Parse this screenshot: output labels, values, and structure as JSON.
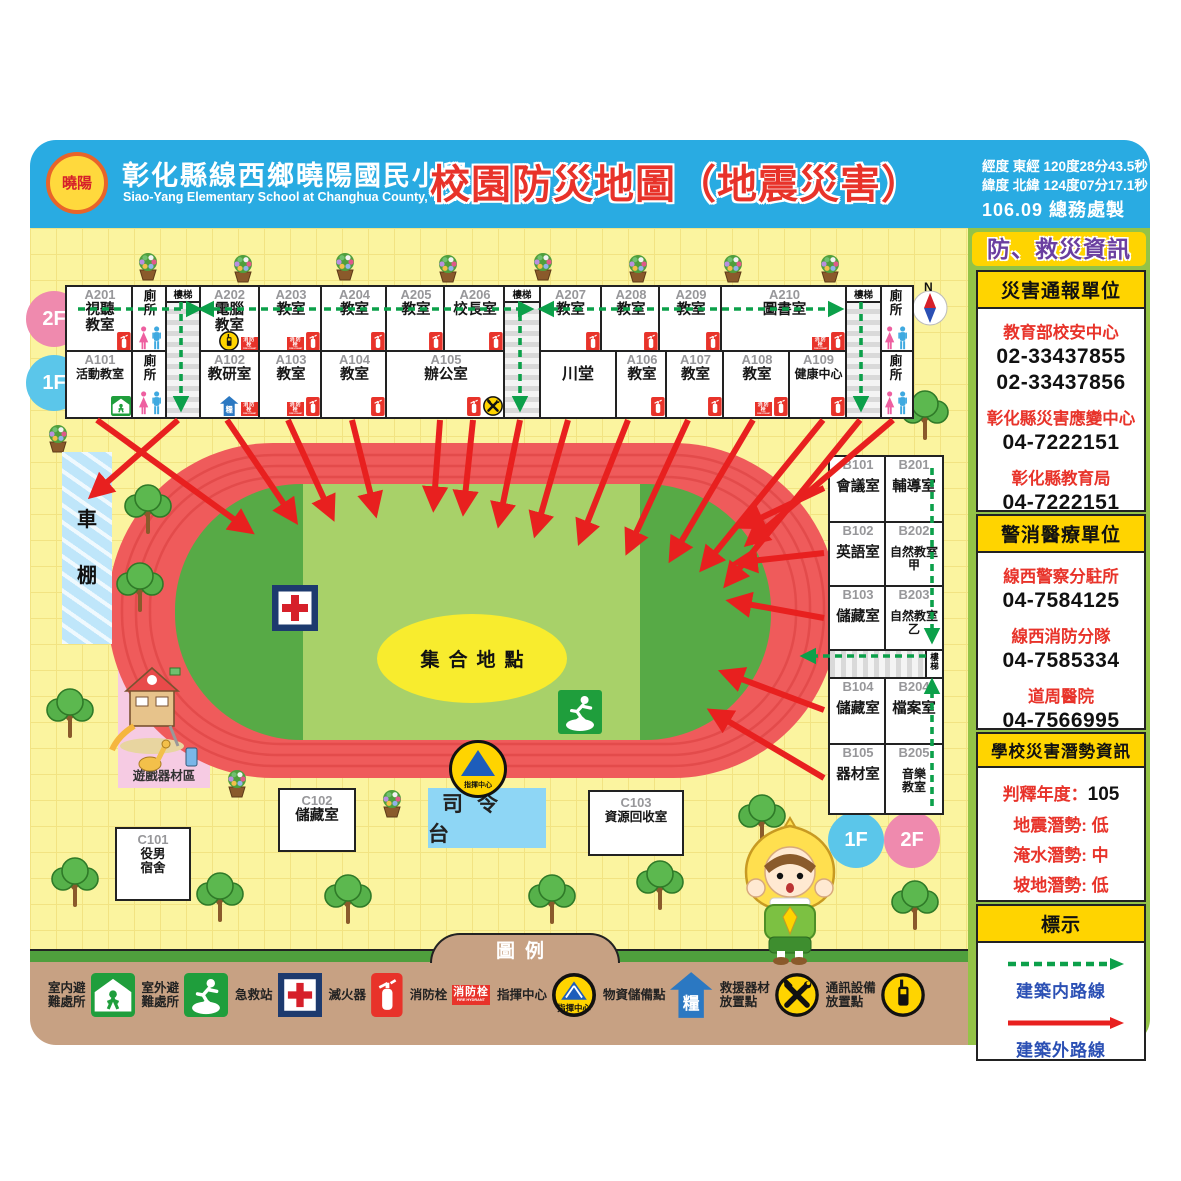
{
  "header": {
    "school_name": "彰化縣線西鄉曉陽國民小學",
    "school_name_en": "Siao-Yang Elementary School at Changhua County, Taiwan",
    "title": "校園防災地圖（地震災害）",
    "coord_line1": "經度 東經 120度28分43.5秒",
    "coord_line2": "緯度 北緯 124度07分17.1秒",
    "edition": "106.09 總務處製",
    "logo_text": "曉陽"
  },
  "sidebar": {
    "title": "防、救災資訊",
    "contact_sections": [
      {
        "header": "災害通報單位",
        "height": 238,
        "entries": [
          {
            "name": "教育部校安中心",
            "phones": [
              "02-33437855",
              "02-33437856"
            ]
          },
          {
            "name": "彰化縣災害應變中心",
            "phones": [
              "04-7222151"
            ]
          },
          {
            "name": "彰化縣教育局",
            "phones": [
              "04-7222151"
            ]
          }
        ]
      },
      {
        "header": "警消醫療單位",
        "height": 212,
        "entries": [
          {
            "name": "線西警察分駐所",
            "phones": [
              "04-7584125"
            ]
          },
          {
            "name": "線西消防分隊",
            "phones": [
              "04-7585334"
            ]
          },
          {
            "name": "道周醫院",
            "phones": [
              "04-7566995"
            ]
          }
        ]
      }
    ],
    "potential_section": {
      "header": "學校災害潛勢資訊",
      "year_label": "判釋年度：",
      "year_value": "105",
      "rows": [
        {
          "label": "地震潛勢:",
          "value": "低"
        },
        {
          "label": "淹水潛勢:",
          "value": "中"
        },
        {
          "label": "坡地潛勢:",
          "value": "低"
        },
        {
          "label": "人為潛勢:",
          "value": "低"
        }
      ]
    },
    "routes_section": {
      "header": "標示",
      "routes": [
        {
          "label": "建築内路線",
          "style": "green-dashed"
        },
        {
          "label": "建築外路線",
          "style": "red-solid"
        }
      ]
    }
  },
  "map": {
    "compass": "N",
    "stairs_label": "樓梯",
    "toilet_label": "廁\n所",
    "labels": {
      "assembly": "集合地點",
      "stage": "司令台",
      "command": "指揮中心",
      "shed": "車\n棚",
      "playground": "遊戲器材區"
    },
    "building_a": {
      "f2_badge": "2F",
      "f1_badge": "1F",
      "f2": [
        {
          "id": "A201",
          "name": "視聽\n教室",
          "x": 65,
          "w": 66,
          "icons": [
            "extinguisher"
          ]
        },
        {
          "type": "toilet",
          "x": 131,
          "w": 34
        },
        {
          "id": "A202",
          "name": "電腦\n教室",
          "x": 197,
          "w": 61,
          "icons": [
            "comm-device",
            "hydrant"
          ]
        },
        {
          "id": "A203",
          "name": "教室",
          "x": 258,
          "w": 62,
          "icons": [
            "hydrant",
            "extinguisher"
          ]
        },
        {
          "id": "A204",
          "name": "教室",
          "x": 320,
          "w": 65,
          "icons": [
            "extinguisher"
          ]
        },
        {
          "id": "A205",
          "name": "教室",
          "x": 385,
          "w": 58,
          "icons": [
            "extinguisher"
          ]
        },
        {
          "id": "A206",
          "name": "校長室",
          "x": 443,
          "w": 60,
          "icons": [
            "extinguisher"
          ]
        },
        {
          "id": "A207",
          "name": "教室",
          "x": 537,
          "w": 63,
          "icons": [
            "extinguisher"
          ]
        },
        {
          "id": "A208",
          "name": "教室",
          "x": 600,
          "w": 58,
          "icons": [
            "extinguisher"
          ]
        },
        {
          "id": "A209",
          "name": "教室",
          "x": 658,
          "w": 62,
          "icons": [
            "extinguisher"
          ]
        },
        {
          "id": "A210",
          "name": "圖書室",
          "x": 720,
          "w": 125,
          "icons": [
            "hydrant",
            "extinguisher"
          ]
        },
        {
          "type": "toilet",
          "x": 878,
          "w": 32
        }
      ],
      "f1": [
        {
          "id": "A101",
          "name": "活動教室",
          "x": 65,
          "w": 66,
          "icons": [
            "indoor-shelter"
          ]
        },
        {
          "type": "toilet",
          "x": 131,
          "w": 34
        },
        {
          "id": "A102",
          "name": "教研室",
          "x": 197,
          "w": 61,
          "icons": [
            "supply",
            "hydrant"
          ]
        },
        {
          "id": "A103",
          "name": "教室",
          "x": 258,
          "w": 62,
          "icons": [
            "hydrant",
            "extinguisher"
          ]
        },
        {
          "id": "A104",
          "name": "教室",
          "x": 320,
          "w": 65,
          "icons": [
            "extinguisher"
          ]
        },
        {
          "id": "A105",
          "name": "辦公室",
          "x": 385,
          "w": 118,
          "icons": [
            "extinguisher",
            "rescue-tools"
          ]
        },
        {
          "id": "",
          "name": "川堂",
          "x": 537,
          "w": 78,
          "icons": []
        },
        {
          "id": "A106",
          "name": "教室",
          "x": 615,
          "w": 50,
          "icons": [
            "extinguisher"
          ]
        },
        {
          "id": "A107",
          "name": "教室",
          "x": 665,
          "w": 57,
          "icons": [
            "extinguisher"
          ]
        },
        {
          "id": "A108",
          "name": "教室",
          "x": 722,
          "w": 66,
          "icons": [
            "hydrant",
            "extinguisher"
          ]
        },
        {
          "id": "A109",
          "name": "健康中心",
          "x": 788,
          "w": 57,
          "icons": [
            "extinguisher"
          ]
        },
        {
          "type": "toilet",
          "x": 878,
          "w": 32
        }
      ],
      "stairs": [
        {
          "x": 165,
          "w": 32
        },
        {
          "x": 503,
          "w": 34
        },
        {
          "x": 845,
          "w": 33
        }
      ]
    },
    "building_b": {
      "f1_badge": "1F",
      "f2_badge": "2F",
      "rows": [
        {
          "h": 66,
          "f1": {
            "id": "B101",
            "name": "會議室"
          },
          "f2": {
            "id": "B201",
            "name": "輔導室"
          }
        },
        {
          "h": 64,
          "f1": {
            "id": "B102",
            "name": "英語室"
          },
          "f2": {
            "id": "B202",
            "name": "自然教室\n甲"
          }
        },
        {
          "h": 64,
          "f1": {
            "id": "B103",
            "name": "儲藏室"
          },
          "f2": {
            "id": "B203",
            "name": "自然教室\n乙"
          }
        },
        {
          "h": 28,
          "stairs": true
        },
        {
          "h": 66,
          "f1": {
            "id": "B104",
            "name": "儲藏室"
          },
          "f2": {
            "id": "B204",
            "name": "檔案室"
          }
        },
        {
          "h": 68,
          "f1": {
            "id": "B105",
            "name": "器材室"
          },
          "f2": {
            "id": "B205",
            "name": "音樂\n教室"
          }
        }
      ]
    },
    "c_rooms": [
      {
        "id": "C101",
        "name": "役男\n宿舍",
        "x": 115,
        "y": 827,
        "w": 72,
        "h": 70
      },
      {
        "id": "C102",
        "name": "儲藏室",
        "x": 278,
        "y": 788,
        "w": 74,
        "h": 60
      },
      {
        "id": "C103",
        "name": "資源回收室",
        "x": 588,
        "y": 790,
        "w": 92,
        "h": 62
      }
    ],
    "routes": {
      "green": [
        [
          78,
          309,
          196,
          309
        ],
        [
          316,
          309,
          204,
          309
        ],
        [
          324,
          309,
          528,
          309
        ],
        [
          654,
          309,
          544,
          309
        ],
        [
          662,
          309,
          838,
          309
        ],
        [
          181,
          302,
          181,
          406
        ],
        [
          520,
          302,
          520,
          406
        ],
        [
          861,
          302,
          861,
          406
        ],
        [
          932,
          468,
          932,
          638
        ],
        [
          926,
          656,
          806,
          656
        ],
        [
          932,
          806,
          932,
          684
        ]
      ],
      "red": [
        [
          97,
          420,
          246,
          528
        ],
        [
          178,
          420,
          96,
          492
        ],
        [
          227,
          420,
          292,
          516
        ],
        [
          288,
          420,
          330,
          512
        ],
        [
          352,
          420,
          374,
          508
        ],
        [
          440,
          420,
          434,
          502
        ],
        [
          473,
          420,
          464,
          506
        ],
        [
          520,
          420,
          500,
          518
        ],
        [
          568,
          420,
          537,
          528
        ],
        [
          628,
          420,
          582,
          536
        ],
        [
          688,
          420,
          630,
          546
        ],
        [
          753,
          420,
          674,
          554
        ],
        [
          823,
          420,
          706,
          564
        ],
        [
          860,
          420,
          730,
          580
        ],
        [
          893,
          420,
          752,
          540
        ],
        [
          824,
          488,
          748,
          524
        ],
        [
          824,
          553,
          742,
          562
        ],
        [
          824,
          618,
          736,
          602
        ],
        [
          824,
          710,
          728,
          674
        ],
        [
          824,
          778,
          716,
          714
        ]
      ]
    }
  },
  "icons": {
    "hydrant_label": "消防栓",
    "hydrant_label_en": "FIRE HYDRANT",
    "supply_char": "糧",
    "command_label": "指揮中心"
  },
  "legend": {
    "title": "圖例",
    "items": [
      {
        "label": "室内避\n難處所",
        "icon": "indoor-shelter"
      },
      {
        "label": "室外避\n難處所",
        "icon": "outdoor-shelter"
      },
      {
        "label": "急救站",
        "icon": "first-aid"
      },
      {
        "label": "滅火器",
        "icon": "extinguisher"
      },
      {
        "label": "消防栓",
        "icon": "hydrant"
      },
      {
        "label": "指揮中心",
        "icon": "command"
      },
      {
        "label": "物資儲備點",
        "icon": "supply"
      },
      {
        "label": "救援器材\n放置點",
        "icon": "rescue-tools"
      },
      {
        "label": "通訊設備\n放置點",
        "icon": "comm-device"
      }
    ]
  }
}
